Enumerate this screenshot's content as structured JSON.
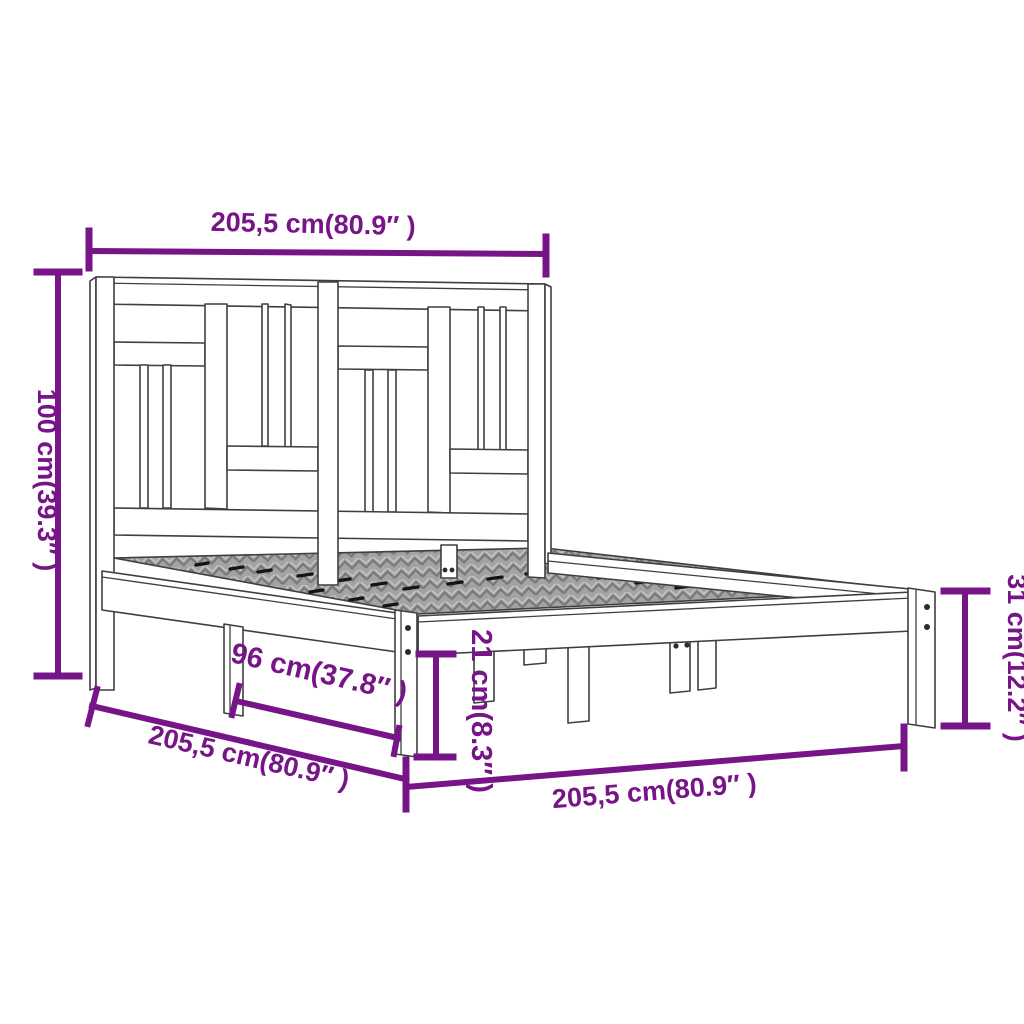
{
  "title": "Bed frame dimension diagram",
  "colors": {
    "dimension_accent": "#771487",
    "outline": "#3f3f3f",
    "slat_fill": "#a3a3a3"
  },
  "dimensions": {
    "top_length": {
      "label": "205,5 cm(80.9″ )"
    },
    "headboard_height": {
      "label": "100 cm(39.3″ )"
    },
    "foot_end_height": {
      "label": "31 cm(12.2″ )"
    },
    "under_bed_clearance": {
      "label": "21 cm(8.3″ )"
    },
    "support_spacing": {
      "label": "96 cm(37.8″ )"
    },
    "side_length": {
      "label": "205,5 cm(80.9″ )"
    },
    "front_width": {
      "label": "205,5 cm(80.9″ )"
    }
  }
}
